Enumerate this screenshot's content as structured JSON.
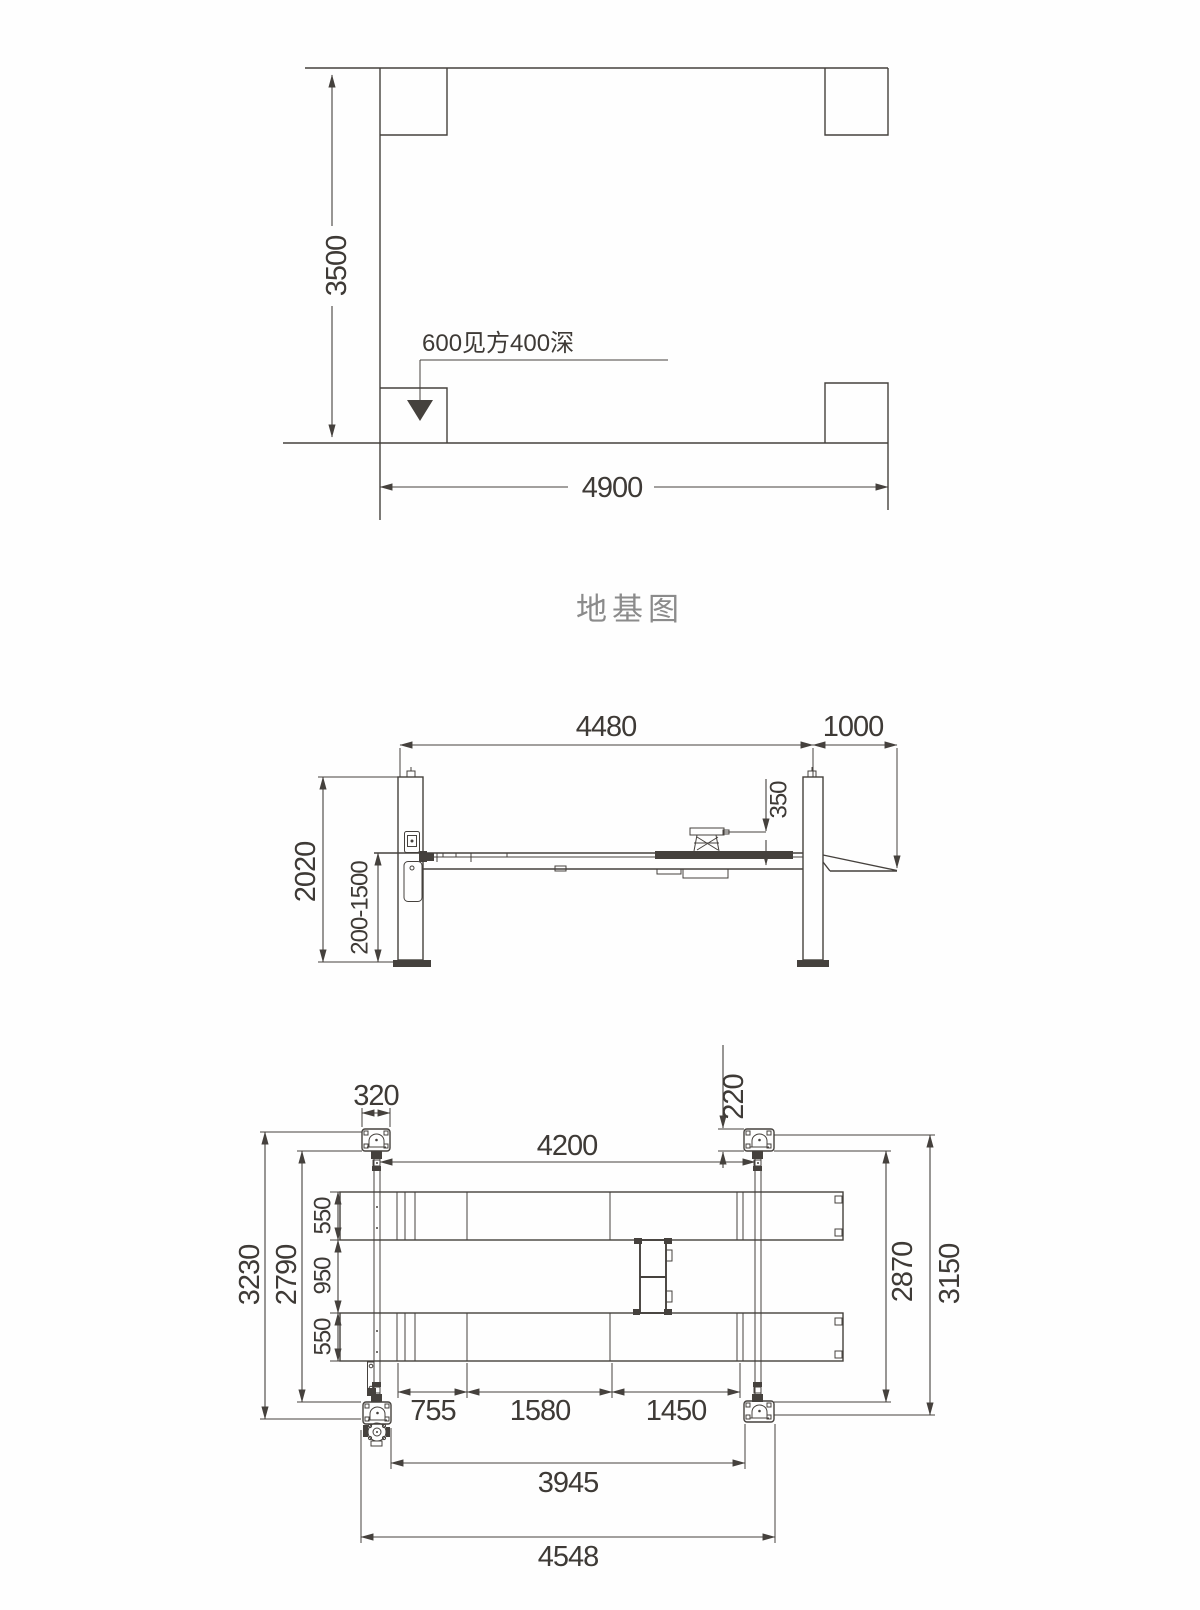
{
  "foundation": {
    "caption": "地基图",
    "width": "3500",
    "length": "4900",
    "pit_note": "600见方400深"
  },
  "elevation": {
    "span": "4480",
    "ramp_length": "1000",
    "pad_height": "350",
    "column_height": "2020",
    "lift_range": "200-1500"
  },
  "plan": {
    "base_plate_width": "320",
    "base_plate_depth": "220",
    "post_spacing": "4200",
    "runway_width_front": "550",
    "runway_gap": "950",
    "runway_width_rear": "550",
    "frame_inner_width": "2790",
    "frame_outer_width": "3230",
    "right_inner_width": "2870",
    "right_outer_width": "3150",
    "section_a": "755",
    "section_b": "1580",
    "section_c": "1450",
    "clear_length": "3945",
    "overall_length": "4548"
  },
  "colors": {
    "line": "#45413d",
    "text": "#3e3a36",
    "caption": "#8b8b8b"
  }
}
